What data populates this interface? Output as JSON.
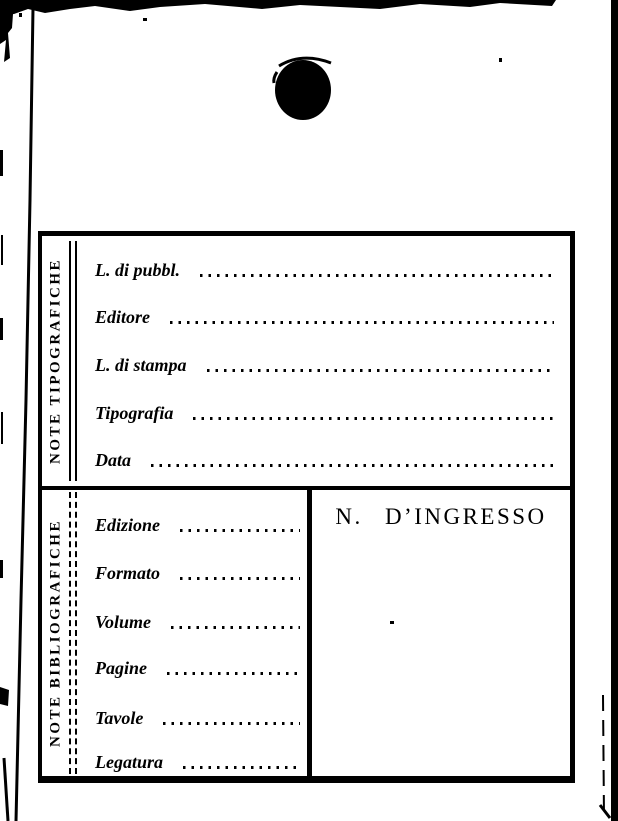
{
  "colors": {
    "ink": "#000000",
    "paper": "#ffffff"
  },
  "card": {
    "sections": [
      {
        "side_label": "NOTE TIPOGRAFICHE",
        "fields": [
          {
            "label": "L. di pubbl.",
            "value": ""
          },
          {
            "label": "Editore",
            "value": ""
          },
          {
            "label": "L. di stampa",
            "value": ""
          },
          {
            "label": "Tipografia",
            "value": ""
          },
          {
            "label": "Data",
            "value": ""
          }
        ]
      },
      {
        "side_label": "NOTE BIBLIOGRAFICHE",
        "fields": [
          {
            "label": "Edizione",
            "value": ""
          },
          {
            "label": "Formato",
            "value": ""
          },
          {
            "label": "Volume",
            "value": ""
          },
          {
            "label": "Pagine",
            "value": ""
          },
          {
            "label": "Tavole",
            "value": ""
          },
          {
            "label": "Legatura",
            "value": ""
          }
        ],
        "ingresso_label": "N. D’INGRESSO"
      }
    ]
  }
}
